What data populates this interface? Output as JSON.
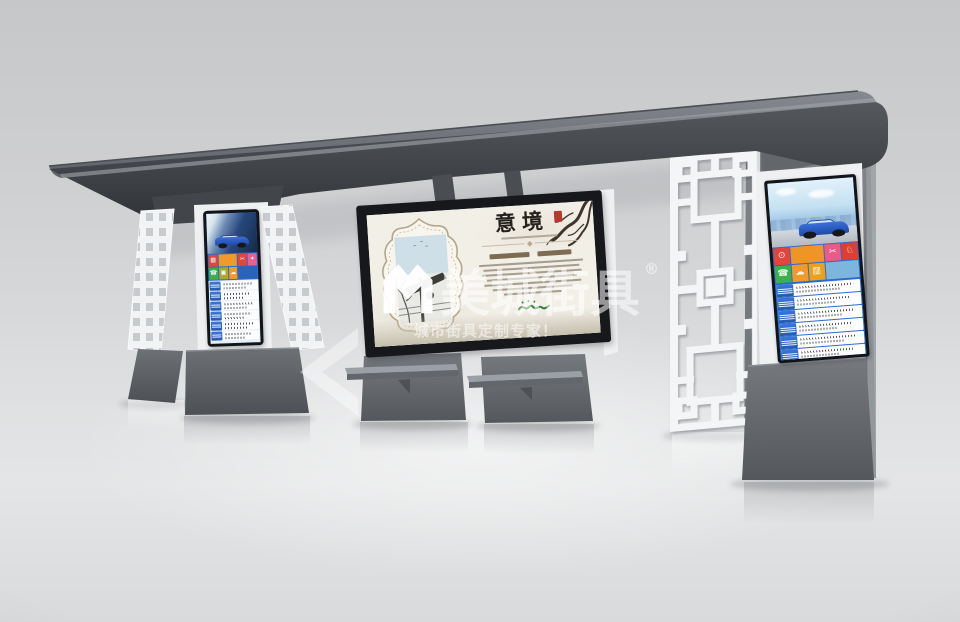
{
  "watermark": {
    "brand": "美城街具",
    "registered_mark": "®",
    "tagline": "城市街具定制专家！",
    "logo": "m-monogram",
    "color": "#ffffff"
  },
  "poster": {
    "title": "意境",
    "title_color": "#26221d",
    "seal_color": "#b43a2e",
    "signature_color": "#2e7d35",
    "paper_color": "#f2efe7"
  },
  "shelter": {
    "roof_color": "#4a4d52",
    "pillar_gray": "#7c8085",
    "structure_white": "#f2f3f5",
    "screen_bezel": "#131417",
    "screen_blue": "#2a6bcf"
  },
  "screens": {
    "left": {
      "ad": "blue-suv-advertisement",
      "row_count": 6,
      "tiles": [
        {
          "color": "#e2453b",
          "icon": "grid-icon",
          "glyph": "▦"
        },
        {
          "color": "#f09a2a",
          "icon": "car-ad-tile",
          "glyph": "",
          "wide": true
        },
        {
          "color": "#e2453b",
          "icon": "scissors-icon",
          "glyph": "✂"
        },
        {
          "color": "#ec5f8e",
          "icon": "gift-icon",
          "glyph": "✦"
        },
        {
          "color": "#3fae4c",
          "icon": "phone-icon",
          "glyph": "☎"
        },
        {
          "color": "#a8a832",
          "icon": "lock-icon",
          "glyph": "▣"
        },
        {
          "color": "#f09a2a",
          "icon": "cloud-icon",
          "glyph": "☁"
        },
        {
          "color": "#2b63b8",
          "icon": "car-photo-tile",
          "glyph": "",
          "wide": true
        }
      ]
    },
    "right": {
      "ad": "blue-suv-advertisement",
      "row_count": 6,
      "tiles": [
        {
          "color": "#e2453b",
          "icon": "search-icon",
          "glyph": "⊙"
        },
        {
          "color": "#ef9426",
          "icon": "city-sunset-tile",
          "glyph": "",
          "wide": true
        },
        {
          "color": "#ea5b86",
          "icon": "scissors-icon",
          "glyph": "✂"
        },
        {
          "color": "#dd3f35",
          "icon": "lion-badge-icon",
          "glyph": "♘"
        },
        {
          "color": "#3fae4c",
          "icon": "phone-icon",
          "glyph": "☎"
        },
        {
          "color": "#f09a2a",
          "icon": "cloud-icon",
          "glyph": "☁"
        },
        {
          "color": "#eaa21e",
          "icon": "chart-icon",
          "glyph": "▥"
        },
        {
          "color": "#7db6dd",
          "icon": "pool-photo-tile",
          "glyph": "",
          "wide": true
        }
      ]
    }
  }
}
